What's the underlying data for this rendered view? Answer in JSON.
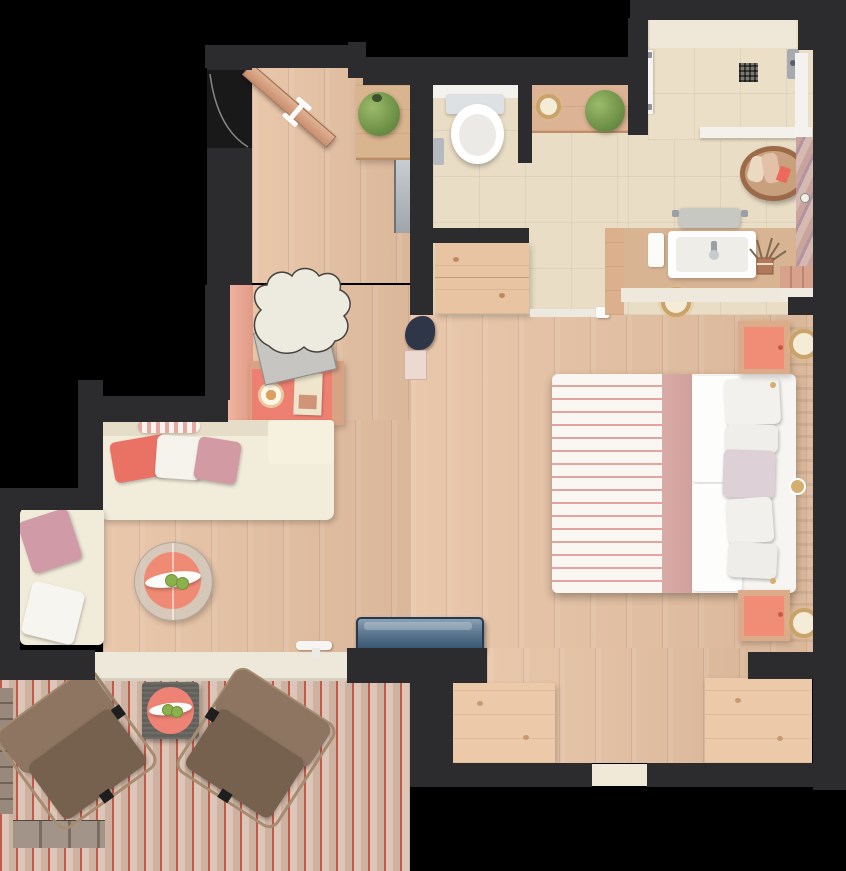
{
  "page": {
    "title": "Apartment floor plan",
    "description": "Top-down 3D rendered floor plan of a studio suite with entry hall, WC, bathroom with vanity, walk-in shower, wardrobe niche, combined bedroom and living area, and a wooden terrace"
  },
  "rooms": [
    {
      "id": "entry",
      "name": "Entry hall"
    },
    {
      "id": "wc",
      "name": "WC"
    },
    {
      "id": "bathroom",
      "name": "Bathroom with vanity"
    },
    {
      "id": "shower",
      "name": "Walk-in shower"
    },
    {
      "id": "wardrobe",
      "name": "Wardrobe niche"
    },
    {
      "id": "living",
      "name": "Living area"
    },
    {
      "id": "bedroom",
      "name": "Bedroom"
    },
    {
      "id": "terrace",
      "name": "Terrace"
    }
  ],
  "furniture": {
    "entry": [
      "open entrance door with swing arc",
      "coat closet with potted plant",
      "wall mirror",
      "desk with coral top, round tray and menu card",
      "sculptural cream desk chair",
      "salmon side ledge"
    ],
    "wc": [
      "toilet with cistern",
      "toilet paper holder"
    ],
    "bathroom": [
      "wooden shelf with candle and green plant",
      "wooden storage chest",
      "sliding-door threshold",
      "vanity counter with white sink and faucet",
      "folded towel",
      "dried-flower vase",
      "towel stool",
      "candle tray",
      "wicker laundry basket with towels",
      "lower shelf"
    ],
    "shower": [
      "glass door",
      "floor drain",
      "shower fixture",
      "glass partitions",
      "marble-textured wardrobe column"
    ],
    "bedroom": [
      "double bed with pink striped blanket, dusty-rose runner, white duvet and pillow stack",
      "upholstered headboard bench",
      "two nightstands with coral tops",
      "two gold table lamps",
      "two window-seat platforms",
      "dark potted plant",
      "magazine stack"
    ],
    "living": [
      "L-shaped cream sofa",
      "coral, white and mauve cushions",
      "striped throw roll",
      "round glass coffee table with coral top",
      "white fruit bowl with green apples"
    ],
    "terrace": [
      "two brown lounge armchairs",
      "wicker side table with coral top and fruit bowl",
      "navy planter box on parapet",
      "sliding-door sill with handle",
      "stone border strips"
    ]
  },
  "palette": {
    "background": "#000000",
    "wall": "#2c2b2d",
    "wood_floor": "#e6c1a2",
    "bath_tile": "#e9ddc5",
    "deck_plank": "#d6bcab",
    "deck_joint": "#c05a49",
    "sofa_cream": "#f2ecda",
    "coral": "#ee8274",
    "mauve": "#d29aa3",
    "bed_white": "#f9f6f2",
    "bed_stripe": "#e3a49f",
    "dusty_rose": "#d9aba7",
    "terrace_chair": "#8d7561",
    "plant_green": "#6f9247",
    "marble": "#c4a19b",
    "gold": "#c49a62",
    "slate_planter": "#5f7b93"
  }
}
